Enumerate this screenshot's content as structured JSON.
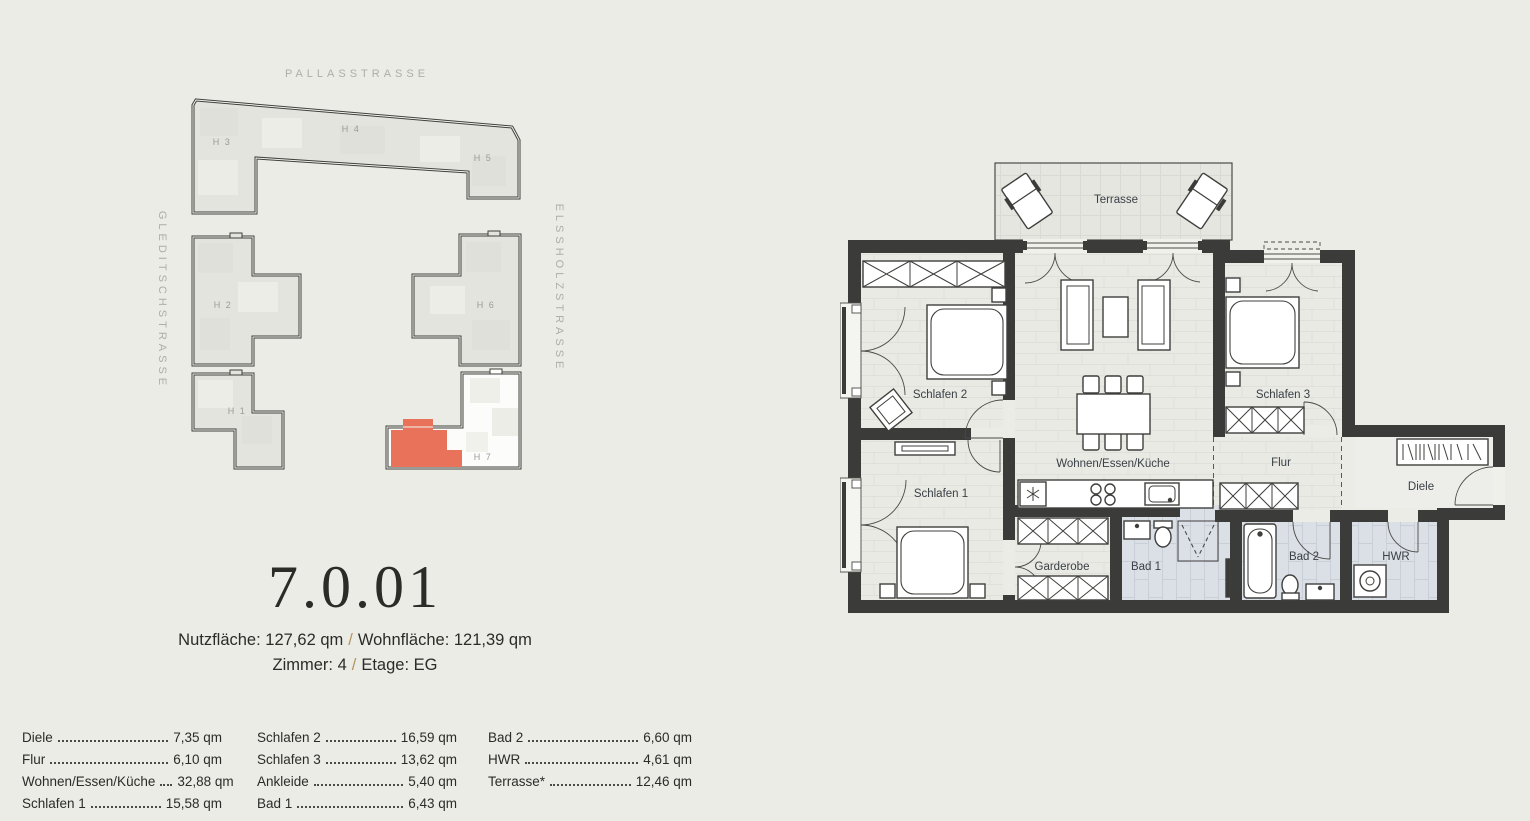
{
  "site_plan": {
    "street_top": "PALLASSTRASSE",
    "street_left": "GLEDITSCHSTRASSE",
    "street_right": "ELSSHOLZSTRASSE",
    "buildings": {
      "h1": "H 1",
      "h2": "H 2",
      "h3": "H 3",
      "h4": "H 4",
      "h5": "H 5",
      "h6": "H 6",
      "h7": "H 7"
    },
    "highlight_color": "#E8735A"
  },
  "unit": {
    "number": "7.0.01",
    "nutzflaeche": "Nutzfläche: 127,62 qm",
    "wohnflaeche": "Wohnfläche: 121,39 qm",
    "zimmer": "Zimmer: 4",
    "etage": "Etage: EG",
    "separator": "/"
  },
  "area_table": {
    "col1": [
      {
        "label": "Diele",
        "value": "7,35 qm"
      },
      {
        "label": "Flur",
        "value": "6,10 qm"
      },
      {
        "label": "Wohnen/Essen/Küche",
        "value": "32,88 qm"
      },
      {
        "label": "Schlafen 1",
        "value": "15,58 qm"
      }
    ],
    "col2": [
      {
        "label": "Schlafen 2",
        "value": "16,59 qm"
      },
      {
        "label": "Schlafen 3",
        "value": "13,62 qm"
      },
      {
        "label": "Ankleide",
        "value": "5,40 qm"
      },
      {
        "label": "Bad 1",
        "value": "6,43 qm"
      }
    ],
    "col3": [
      {
        "label": "Bad 2",
        "value": "6,60 qm"
      },
      {
        "label": "HWR",
        "value": "4,61 qm"
      },
      {
        "label": "Terrasse*",
        "value": "12,46 qm"
      }
    ]
  },
  "floor_plan": {
    "rooms": {
      "terrasse": "Terrasse",
      "schlafen2": "Schlafen 2",
      "schlafen1": "Schlafen 1",
      "wohnen": "Wohnen/Essen/Küche",
      "schlafen3": "Schlafen 3",
      "flur": "Flur",
      "diele": "Diele",
      "garderobe": "Garderobe",
      "bad1": "Bad 1",
      "bad2": "Bad 2",
      "hwr": "HWR"
    }
  }
}
